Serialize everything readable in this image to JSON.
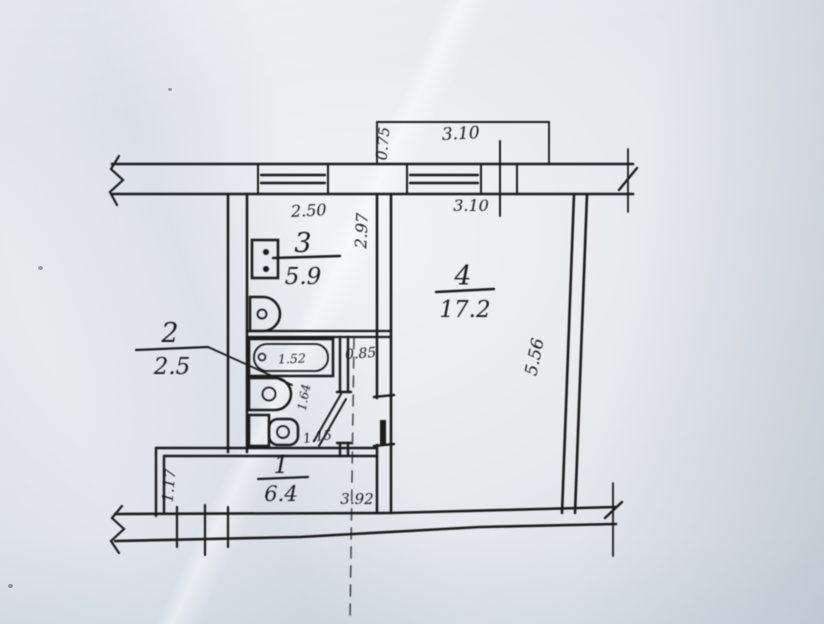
{
  "plan": {
    "rooms": {
      "hall": {
        "number": "1",
        "area": "6.4"
      },
      "bath": {
        "number": "2",
        "area": "2.5"
      },
      "kitchen": {
        "number": "3",
        "area": "5.9"
      },
      "living": {
        "number": "4",
        "area": "17.2"
      }
    },
    "dims": {
      "balcony_width": "3.10",
      "balcony_depth": "0.75",
      "kitchen_window": "2.50",
      "kitchen_depth": "2.97",
      "living_window": "3.10",
      "living_depth": "5.56",
      "corridor_width": "0.85",
      "bathtub_length": "1.52",
      "washbasin": "1.64",
      "toilet": "1.15",
      "hall_side": "1.17",
      "bottom_span": "3.92"
    },
    "colors": {
      "paper": "#e7eaed",
      "ink": "#1d1d1f"
    }
  }
}
